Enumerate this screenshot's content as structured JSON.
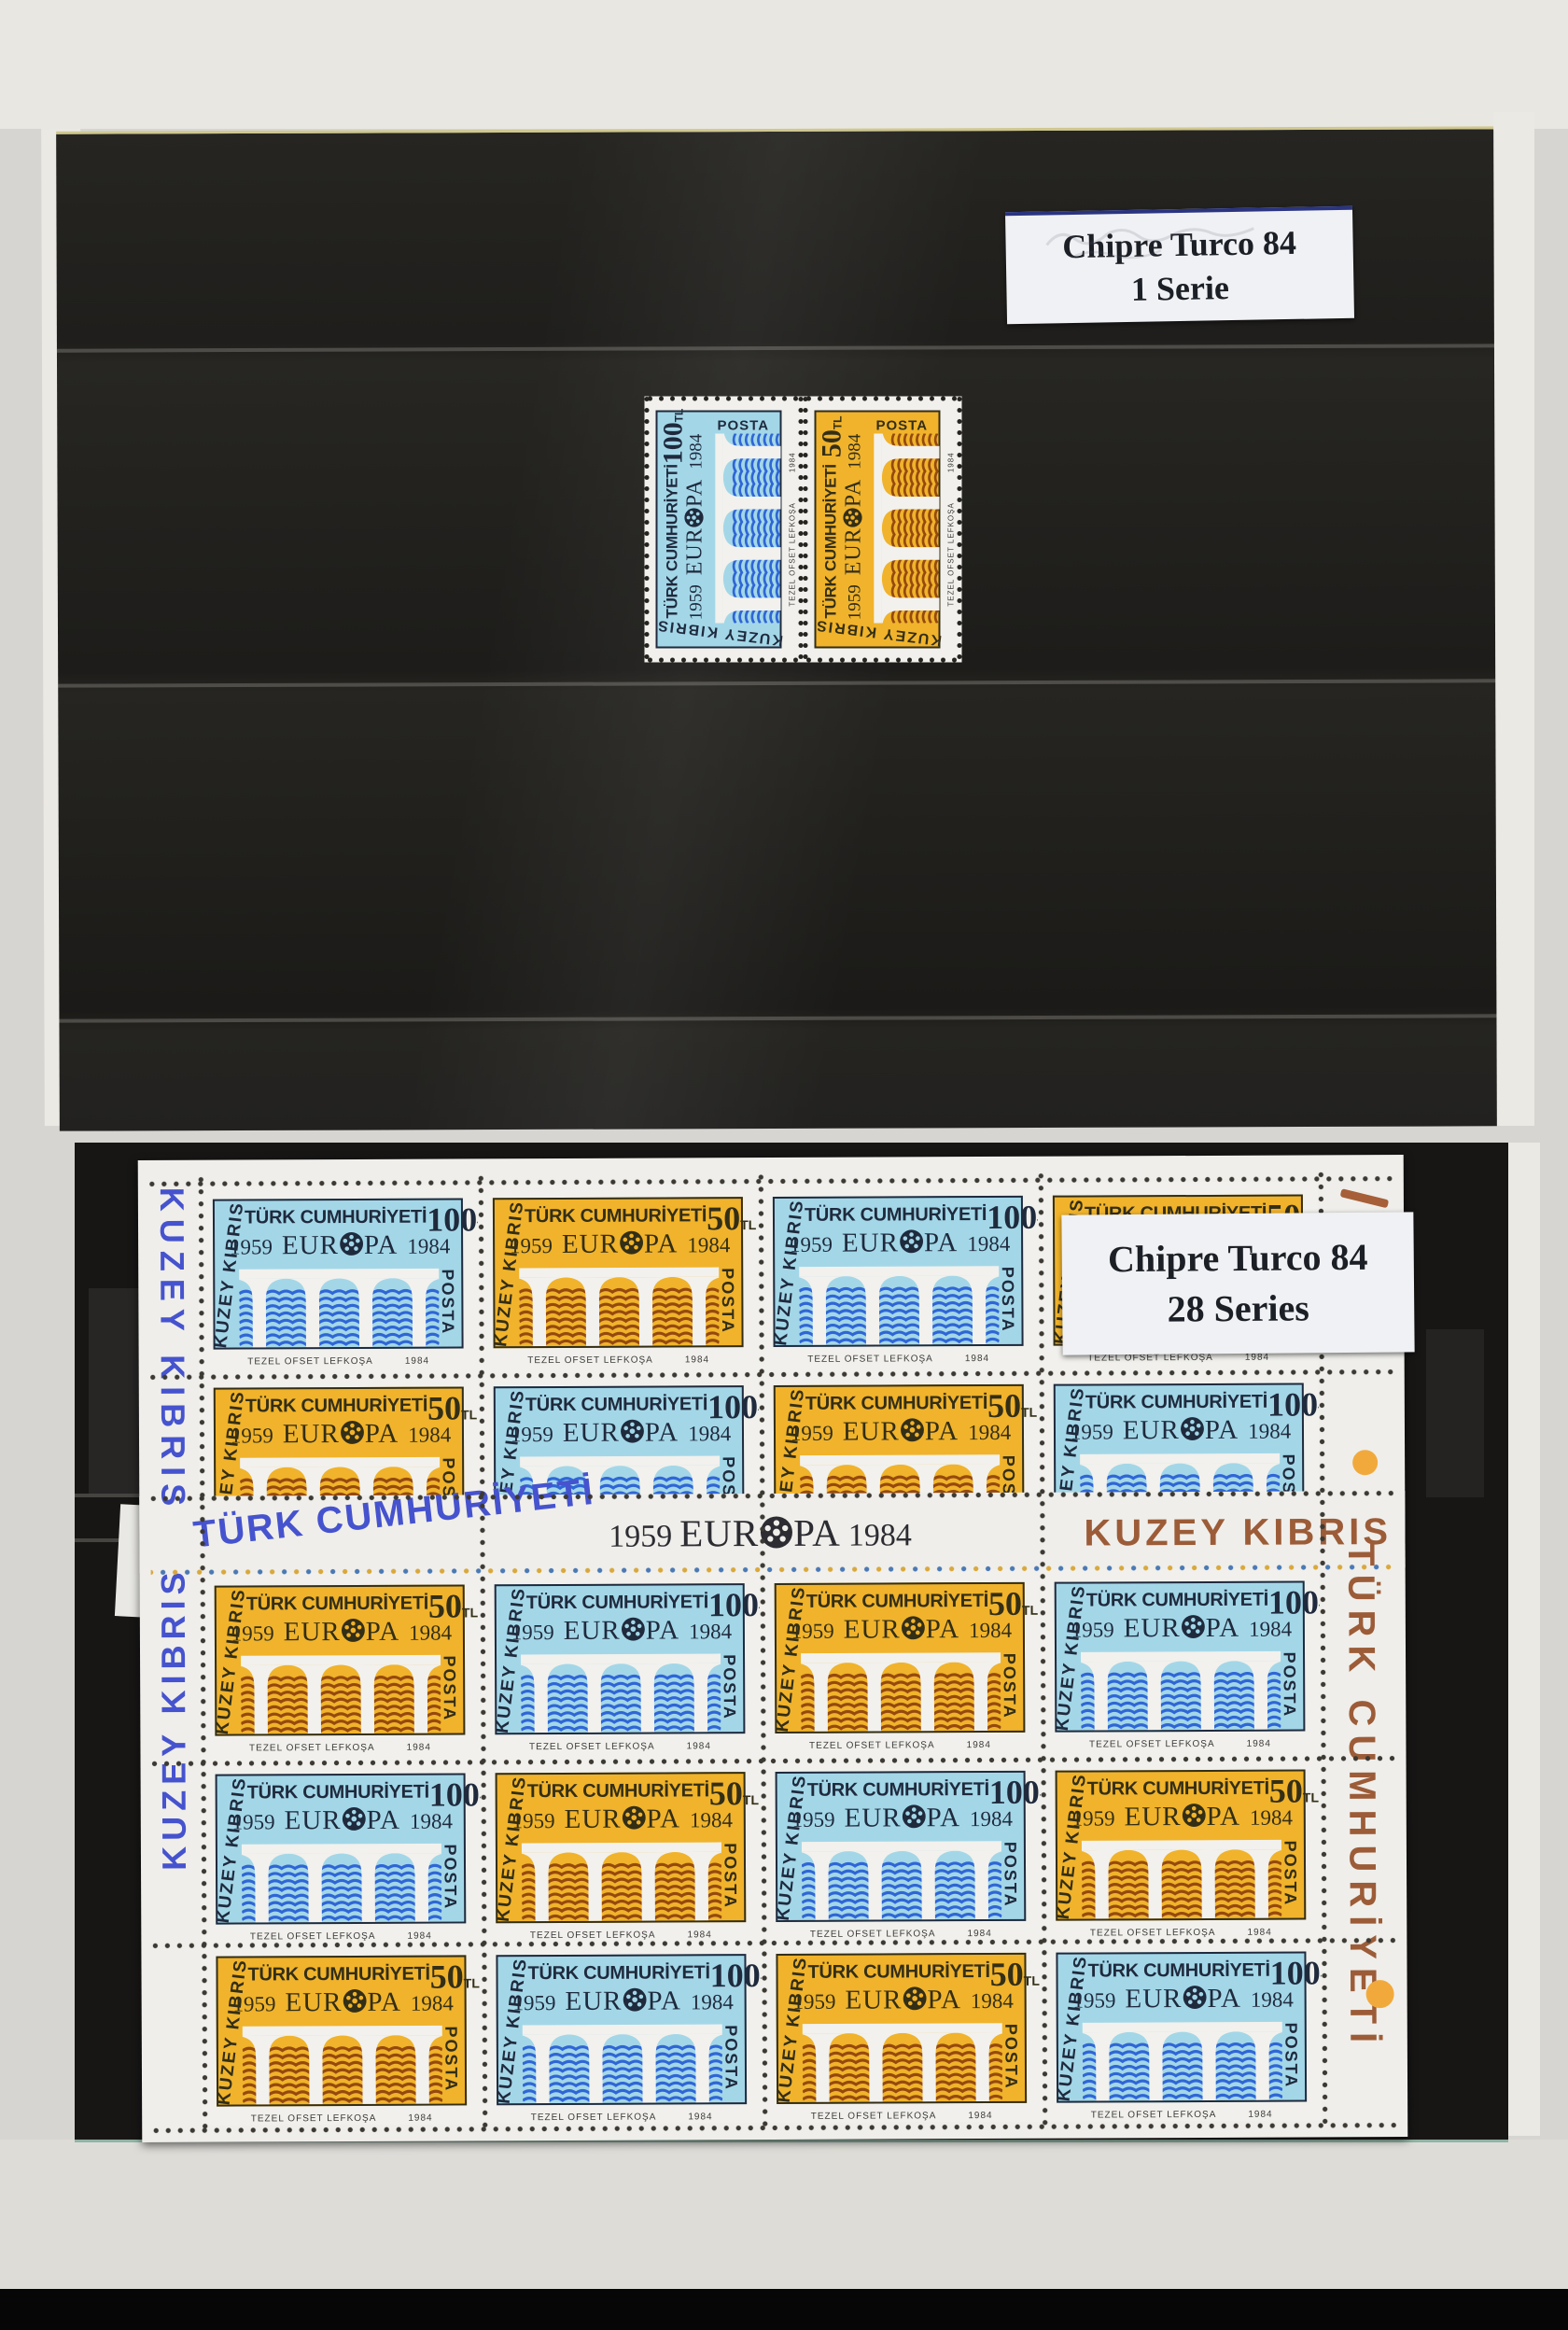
{
  "colors": {
    "backdrop": "#d6d5d1",
    "page_black": "#242220",
    "paper": "#f1f0ec",
    "white": "#f2f1ed",
    "blue_bg": "#a3d7e8",
    "blue_ink": "#1f2a3d",
    "blue_water": "#2f66d6",
    "orange_bg": "#f0b32b",
    "orange_ink": "#332e16",
    "orange_water": "#96490e",
    "gutter_blue": "#4653ce",
    "gutter_dark": "#2c2c32",
    "gutter_brown": "#9c5c38",
    "perf_dot": "#3c3933",
    "margin_dot_orange": "#f2a93c",
    "corner_mark": "#a65f38",
    "imprint_ink": "#3a3a38"
  },
  "top_page": {
    "label": {
      "line1": "Chipre Turco 84",
      "line2": "1 Serie"
    },
    "pair": {
      "stamps": [
        "blue",
        "orange"
      ],
      "rotation_deg": -90
    }
  },
  "bottom_page": {
    "label": {
      "line1": "Chipre Turco 84",
      "line2": "28 Series"
    },
    "sheet": {
      "rows": [
        [
          "blue",
          "orange",
          "blue",
          "orange"
        ],
        [
          "orange",
          "blue",
          "orange",
          "blue"
        ],
        [
          "orange",
          "blue",
          "orange",
          "blue"
        ],
        [
          "blue",
          "orange",
          "blue",
          "orange"
        ],
        [
          "orange",
          "blue",
          "orange",
          "blue"
        ]
      ],
      "gutter": {
        "left": "TÜRK CUMHURİYETİ",
        "center_year_left": "1959",
        "center_word": "EUROPA",
        "center_year_right": "1984",
        "right": "KUZEY KIBRIS"
      },
      "left_margin_text_upper": "KUZEY KIBRIS",
      "left_margin_text_lower": "KUZEY KIBRIS",
      "right_margin_text": "TÜRK CUMHURİYETİ"
    }
  },
  "stamp": {
    "country": "TÜRK CUMHURİYETİ",
    "region": "KUZEY KIBRIS",
    "year_left": "1959",
    "europa": "EUROPA",
    "year_right": "1984",
    "posta": "POSTA",
    "imprint": "TEZEL OFSET LEFKOŞA",
    "imprint_year": "1984",
    "unit": "TL",
    "values": {
      "blue": "100",
      "orange": "50"
    }
  }
}
